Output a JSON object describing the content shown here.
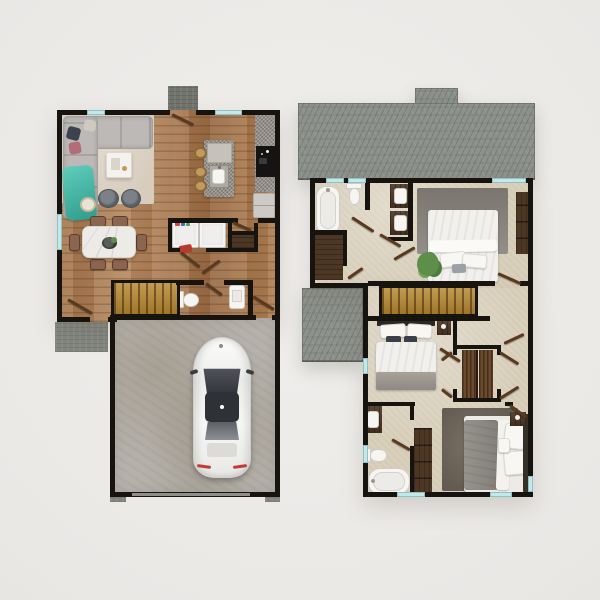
{
  "palette": {
    "bg1": "#f1efec",
    "bg2": "#e0ded9",
    "wall": "#17140f",
    "wood": "#aa7e58",
    "carpet": "#d9d0bc",
    "concrete": "#b6b2ab",
    "porch": "#82867e",
    "stoop": "#70746c",
    "roof": "#8d918b",
    "gold": "#b4862f",
    "darkwood": "#4c3624",
    "rod": "#6b4a2e",
    "leaf": "#5a3a1f",
    "glass": "#c3e8ea",
    "white": "#f6f5f2",
    "sofa": "#bdb9b6",
    "rug": "#d8cdbd",
    "teal": "#45bdab",
    "granite": "#98938b",
    "cooktop": "#141414",
    "appliance": "#efeeec",
    "marble": "#edebe7",
    "chair": "#8a6550",
    "bedgray": "#8b8781",
    "bedrug": "#6e665c",
    "green": "#5d8f4b"
  },
  "scene": {
    "type": "3d-rendered-top-down-floor-plans",
    "visible_text": [],
    "plans": [
      {
        "id": "first-floor",
        "rooms": [
          {
            "name": "living-room",
            "furniture": [
              "l-shaped-sectional-sofa",
              "beige-area-rug",
              "white-coffee-table",
              "two-ottoman-poufs",
              "round-side-table",
              "teal-throw-blanket",
              "throw-pillows"
            ]
          },
          {
            "name": "dining-area",
            "furniture": [
              "marble-dining-table",
              "six-wood-chairs",
              "centerpiece-bowl-with-plant"
            ]
          },
          {
            "name": "kitchen",
            "furniture": [
              "granite-island-with-sink",
              "three-round-bar-stools",
              "granite-wall-counter",
              "black-cooktop",
              "refrigerator-cabinet"
            ]
          },
          {
            "name": "laundry-room",
            "furniture": [
              "washer",
              "dryer",
              "detergent-bottles",
              "red-laundry-basket"
            ]
          },
          {
            "name": "hall-closet",
            "furniture": [
              "dark-wood-shelf"
            ]
          },
          {
            "name": "half-bathroom",
            "furniture": [
              "toilet",
              "vanity-sink"
            ]
          },
          {
            "name": "staircase",
            "furniture": [
              "golden-wood-stairs"
            ]
          },
          {
            "name": "garage",
            "furniture": [
              "white-car"
            ]
          },
          {
            "name": "front-stoop",
            "furniture": []
          },
          {
            "name": "side-porch",
            "furniture": []
          }
        ]
      },
      {
        "id": "second-floor",
        "roof_sections": [
          "main-roof-with-chimney",
          "lower-side-roof"
        ],
        "rooms": [
          {
            "name": "upper-bathroom",
            "furniture": [
              "bathtub",
              "toilet",
              "double-vanity-sinks"
            ]
          },
          {
            "name": "linen-closet",
            "furniture": []
          },
          {
            "name": "bedroom-1",
            "furniture": [
              "bed-with-pillows",
              "gray-area-rug",
              "potted-plant",
              "dark-wood-dresser"
            ]
          },
          {
            "name": "hallway",
            "furniture": []
          },
          {
            "name": "staircase",
            "furniture": [
              "golden-wood-stairs"
            ]
          },
          {
            "name": "bedroom-2",
            "furniture": [
              "bed-with-pillows",
              "nightstand"
            ]
          },
          {
            "name": "walk-in-closet",
            "furniture": [
              "two-hanging-rods",
              "bifold-doors"
            ]
          },
          {
            "name": "lower-bathroom",
            "furniture": [
              "vanity-sink",
              "toilet",
              "bathtub",
              "tall-wardrobe"
            ]
          },
          {
            "name": "bedroom-3",
            "furniture": [
              "bed-with-pillows",
              "dark-area-rug",
              "nightstand",
              "headboard"
            ]
          }
        ]
      }
    ]
  }
}
